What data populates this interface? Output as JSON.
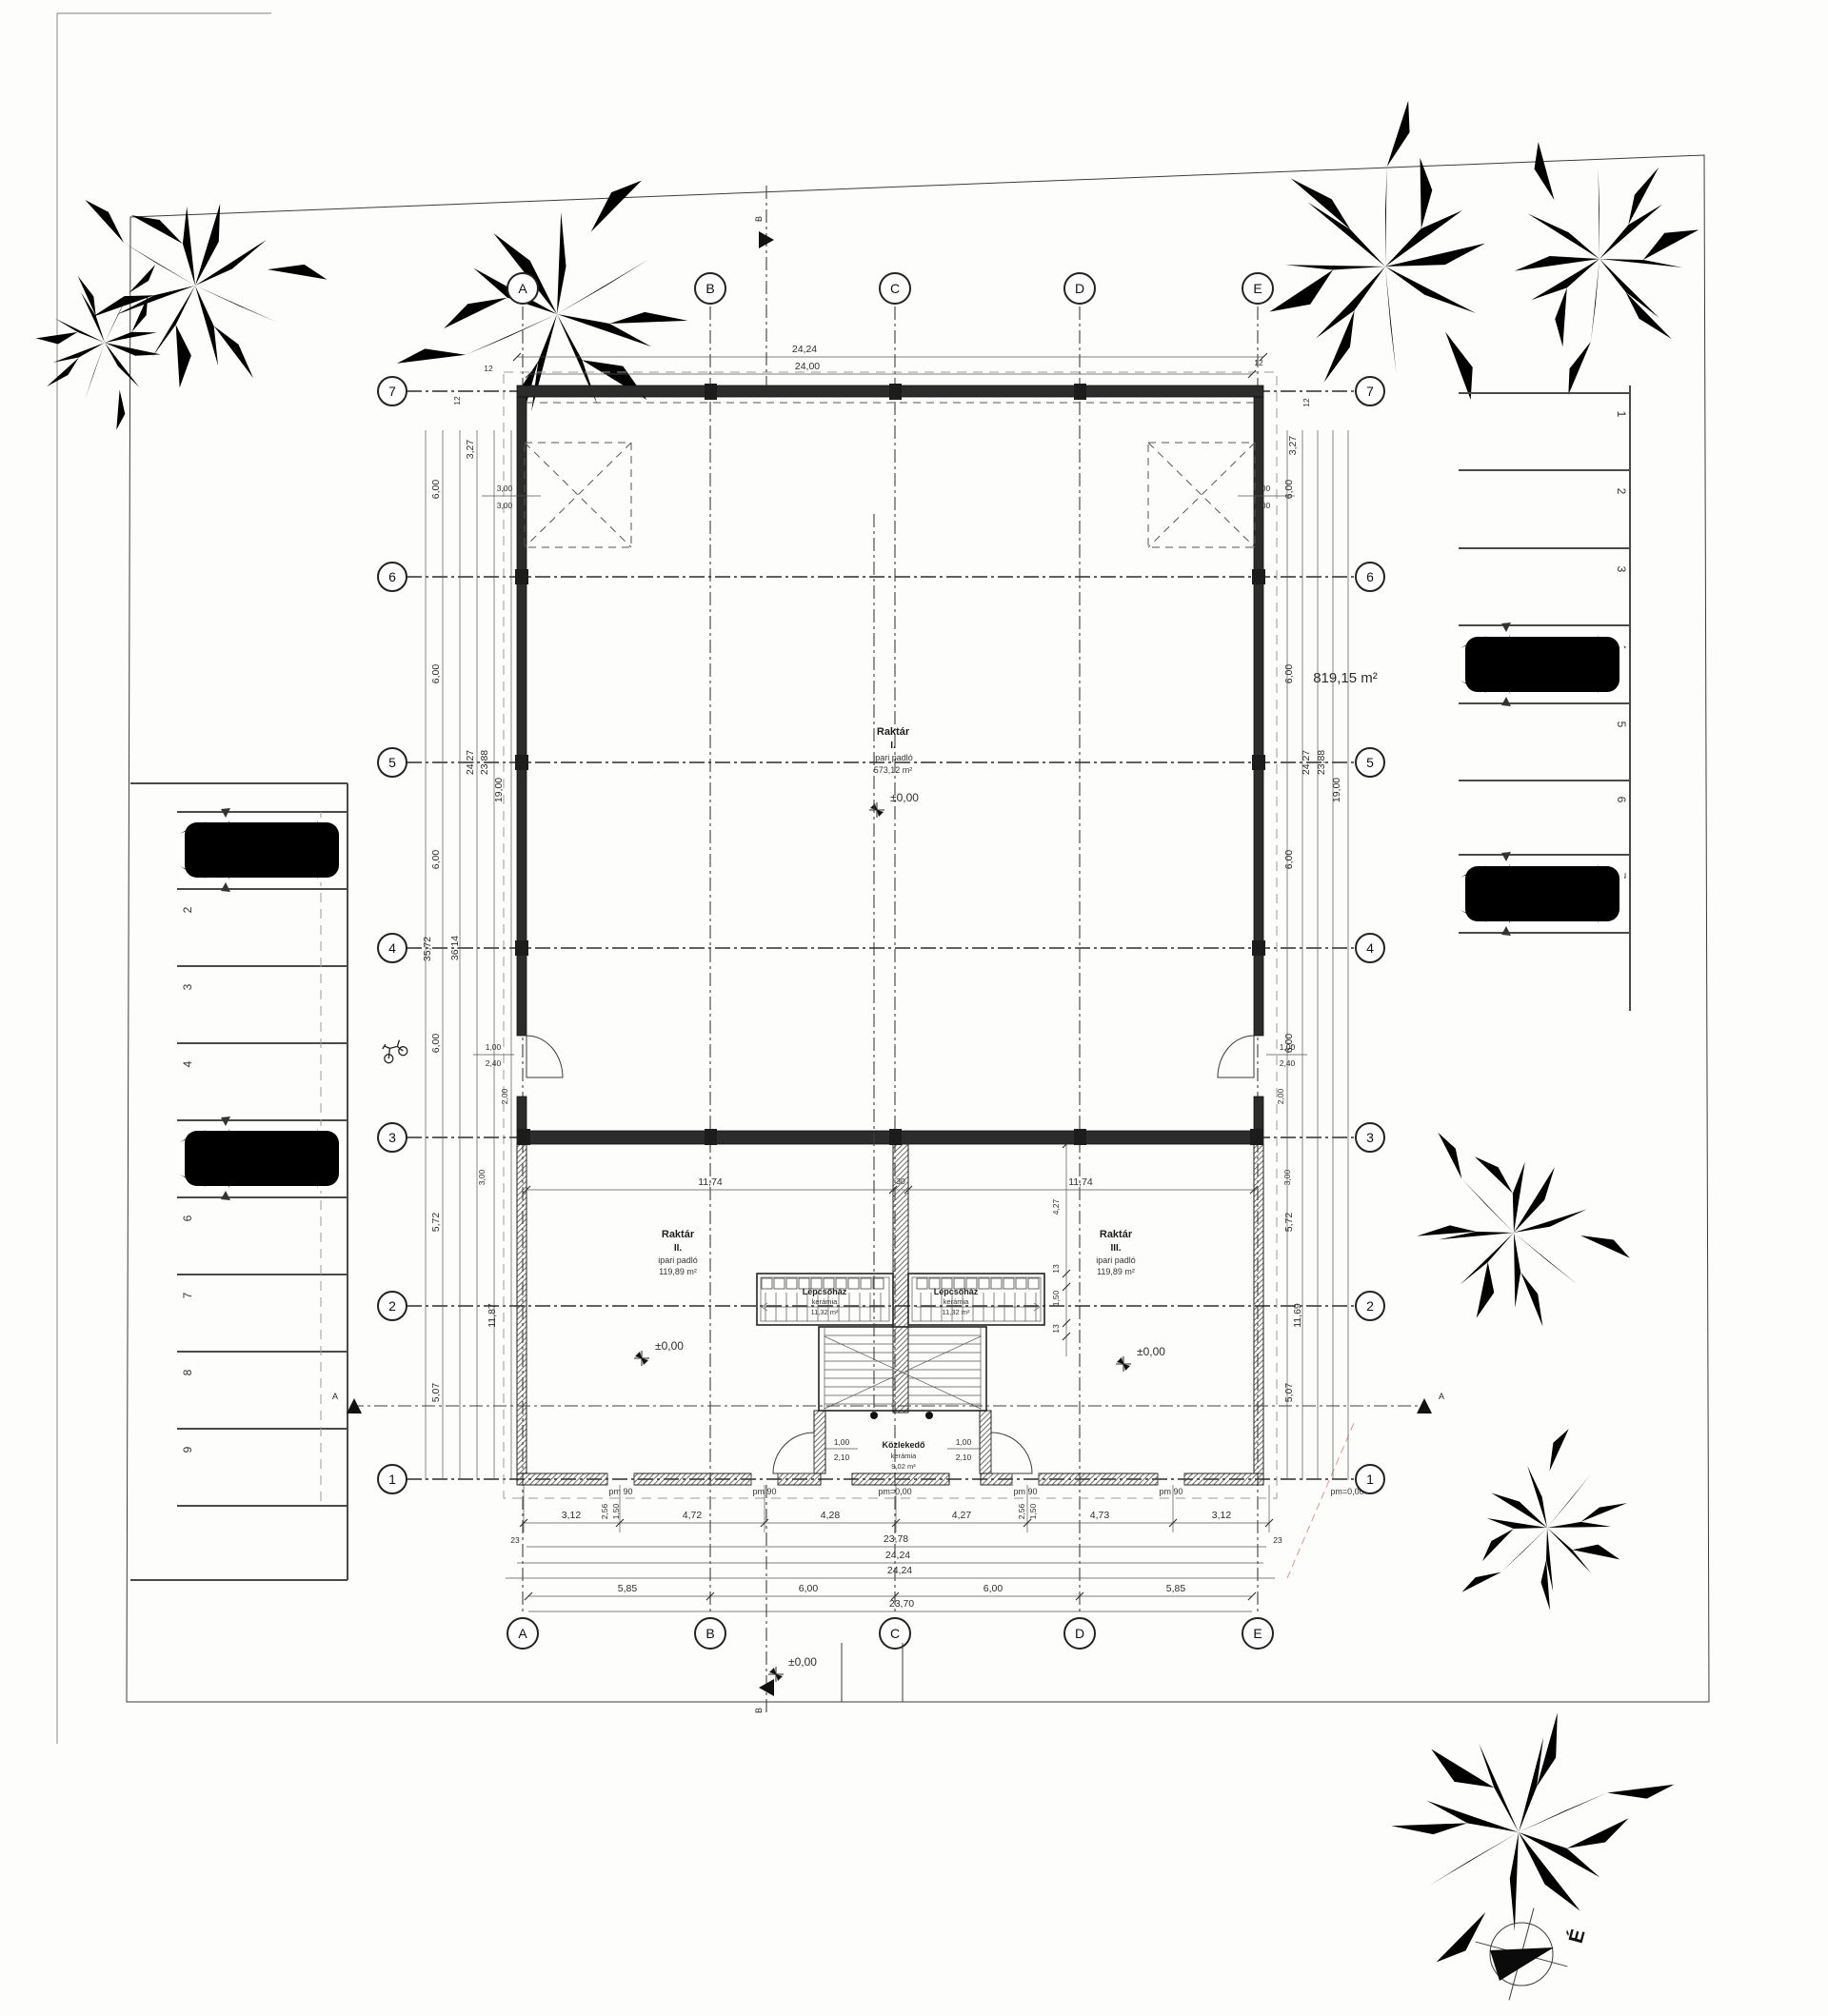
{
  "site": {
    "area": "819,15 m²"
  },
  "compass": {
    "north": "É"
  },
  "grid": {
    "cols": [
      "A",
      "B",
      "C",
      "D",
      "E"
    ],
    "rows": [
      "7",
      "6",
      "5",
      "4",
      "3",
      "2",
      "1"
    ]
  },
  "parking": {
    "left": [
      "1",
      "2",
      "3",
      "4",
      "5",
      "6",
      "7",
      "8",
      "9"
    ],
    "right": [
      "1",
      "2",
      "3",
      "4",
      "5",
      "6",
      "7"
    ]
  },
  "rooms": {
    "raktar1": {
      "name": "Raktár",
      "no": "I.",
      "finish": "ipari padló",
      "area": "573,12 m²"
    },
    "raktar2": {
      "name": "Raktár",
      "no": "II.",
      "finish": "ipari padló",
      "area": "119,89 m²"
    },
    "raktar3": {
      "name": "Raktár",
      "no": "III.",
      "finish": "ipari padló",
      "area": "119,89 m²"
    },
    "stair1": {
      "name": "Lépcsőház",
      "finish": "kerámia",
      "area": "11,32 m²"
    },
    "stair2": {
      "name": "Lépcsőház",
      "finish": "kerámia",
      "area": "11,32 m²"
    },
    "corridor": {
      "name": "Közlekedő",
      "finish": "kerámia",
      "area": "9,02 m²"
    }
  },
  "levels": {
    "zero": "±0,00",
    "pm_zero": "pm=0,00",
    "pm_90": "pm 90"
  },
  "sections": {
    "vertical": "B",
    "horizontal": "A"
  },
  "dims": {
    "top_outer": "24,24",
    "top_axis": "24,00",
    "offset12": "12",
    "skylight": "3,00",
    "v327": "3,27",
    "v600": "6,00",
    "v2427": "24,27",
    "v2388": "23,88",
    "v1900": "19,00",
    "v3572": "35,72",
    "v3614": "36,14",
    "v200": "2,00",
    "v300": "3,00",
    "v1187": "11,87",
    "v1169": "11,69",
    "v572": "5,72",
    "v507": "5,07",
    "roomw": "11,74",
    "wall30": "30",
    "s427": "4,27",
    "s13": "13",
    "s150": "1,50",
    "door_w": "1,00",
    "door_h": "2,10",
    "exit_w": "1,00",
    "exit_h": "2,40",
    "b312": "3,12",
    "b472": "4,72",
    "b428": "4,28",
    "b427": "4,27",
    "b473": "4,73",
    "b23": "23",
    "b2378": "23,78",
    "b2424": "24,24",
    "b585": "5,85",
    "b600": "6,00",
    "b2370": "23,70",
    "j256": "2,56",
    "j150": "1,50"
  }
}
